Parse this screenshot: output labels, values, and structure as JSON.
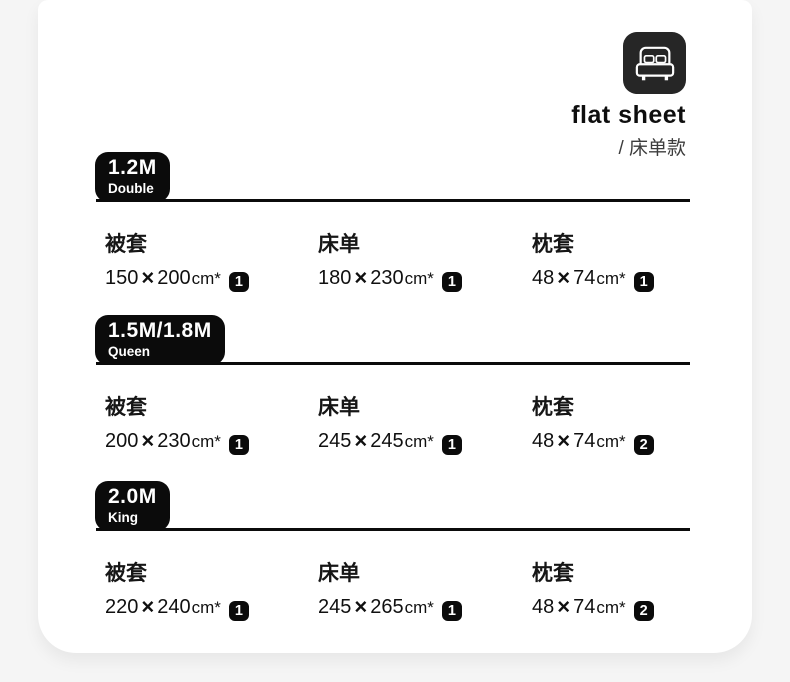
{
  "header": {
    "title": "flat sheet",
    "subtitle": "/ 床单款",
    "icon": "double-bed-icon"
  },
  "symbols": {
    "times": "×"
  },
  "sections": [
    {
      "size": "1.2M",
      "size_label": "Double",
      "items": [
        {
          "label": "被套",
          "width": "150",
          "height": "200",
          "unit": "cm*",
          "qty": "1"
        },
        {
          "label": "床单",
          "width": "180",
          "height": "230",
          "unit": "cm*",
          "qty": "1"
        },
        {
          "label": "枕套",
          "width": "48",
          "height": "74",
          "unit": "cm*",
          "qty": "1"
        }
      ]
    },
    {
      "size": "1.5M/1.8M",
      "size_label": "Queen",
      "items": [
        {
          "label": "被套",
          "width": "200",
          "height": "230",
          "unit": "cm*",
          "qty": "1"
        },
        {
          "label": "床单",
          "width": "245",
          "height": "245",
          "unit": "cm*",
          "qty": "1"
        },
        {
          "label": "枕套",
          "width": "48",
          "height": "74",
          "unit": "cm*",
          "qty": "2"
        }
      ]
    },
    {
      "size": "2.0M",
      "size_label": "King",
      "items": [
        {
          "label": "被套",
          "width": "220",
          "height": "240",
          "unit": "cm*",
          "qty": "1"
        },
        {
          "label": "床单",
          "width": "245",
          "height": "265",
          "unit": "cm*",
          "qty": "1"
        },
        {
          "label": "枕套",
          "width": "48",
          "height": "74",
          "unit": "cm*",
          "qty": "2"
        }
      ]
    }
  ],
  "colors": {
    "accent": "#0b0b0b",
    "icon_bg": "#262626",
    "card_bg": "#ffffff",
    "page_bg": "#f5f5f5",
    "subtitle_text": "#3d3d3d"
  }
}
